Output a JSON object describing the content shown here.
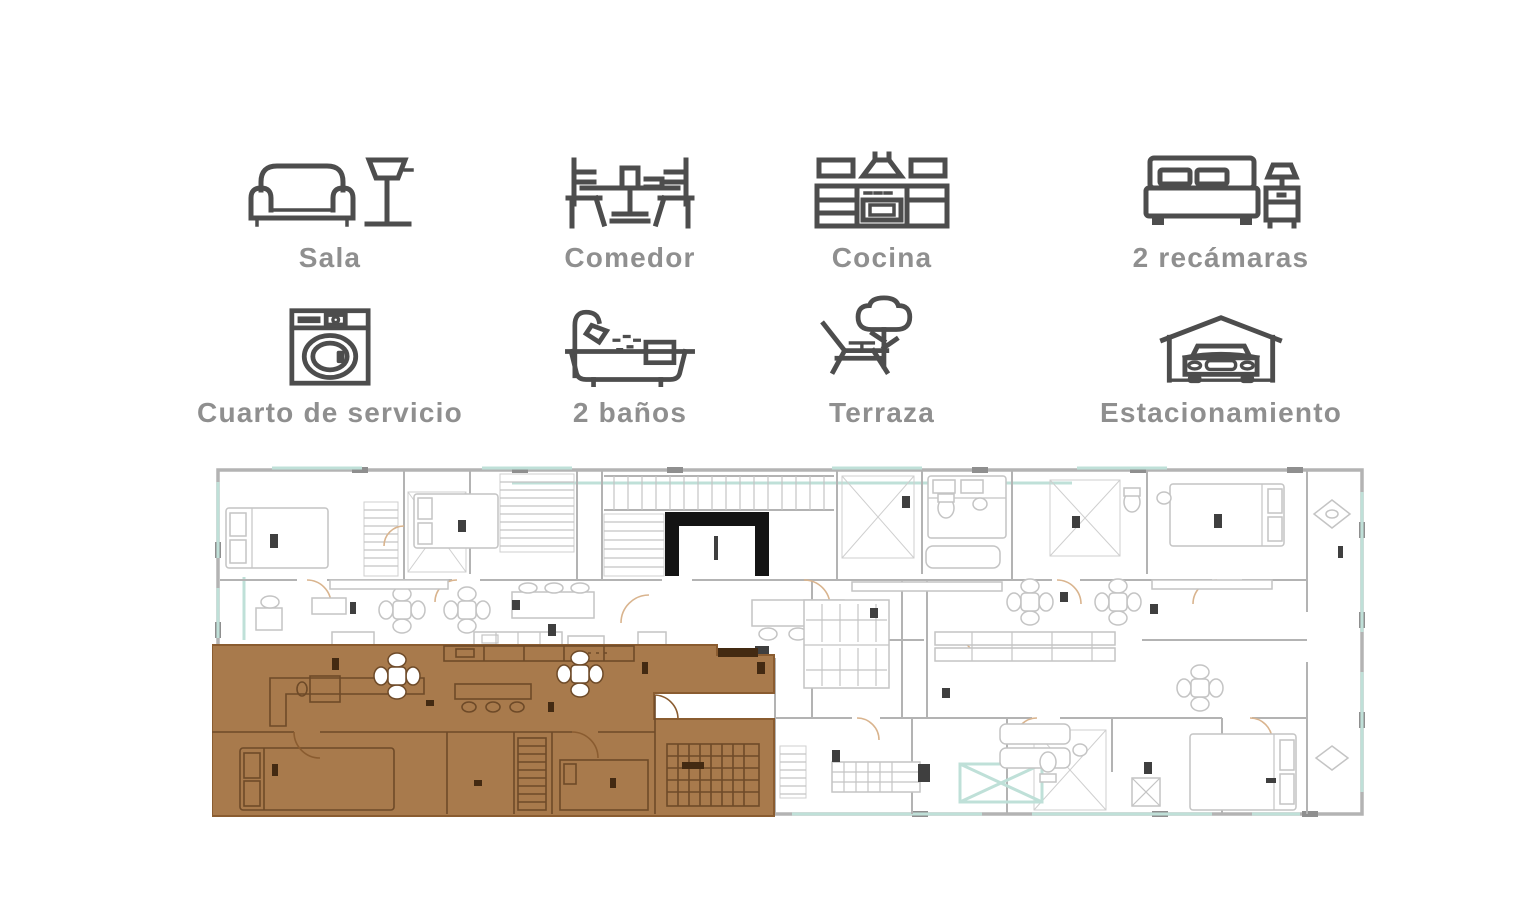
{
  "amenities": {
    "items": [
      {
        "id": "sala",
        "label": "Sala",
        "icon": "sofa-lamp-icon"
      },
      {
        "id": "comedor",
        "label": "Comedor",
        "icon": "dining-set-icon"
      },
      {
        "id": "cocina",
        "label": "Cocina",
        "icon": "kitchen-cabinets-icon"
      },
      {
        "id": "recamaras",
        "label": "2 recámaras",
        "icon": "bed-nightstand-icon"
      },
      {
        "id": "cuarto-de-servicio",
        "label": "Cuarto de servicio",
        "icon": "washing-machine-icon"
      },
      {
        "id": "banos",
        "label": "2 baños",
        "icon": "bathtub-shower-icon"
      },
      {
        "id": "terraza",
        "label": "Terraza",
        "icon": "terrace-tree-lounge-icon"
      },
      {
        "id": "estacionamiento",
        "label": "Estacionamiento",
        "icon": "car-garage-icon"
      }
    ]
  },
  "floor_plan": {
    "type": "architectural-floor-plan",
    "highlighted_unit": {
      "position": "bottom-left",
      "selected": true
    },
    "colors": {
      "icon_stroke": "#4d4d4d",
      "label": "#8f8f8f",
      "walls": "#b3b3b3",
      "windows": "#bfe0d8",
      "doors": "#d9b48e",
      "elevator_core": "#141414",
      "highlight_fill": "#a87a4c",
      "highlight_lines": "#6e4a28",
      "highlight_edge": "#8a5c30",
      "tiny_labels": "#3f3f3f"
    }
  }
}
